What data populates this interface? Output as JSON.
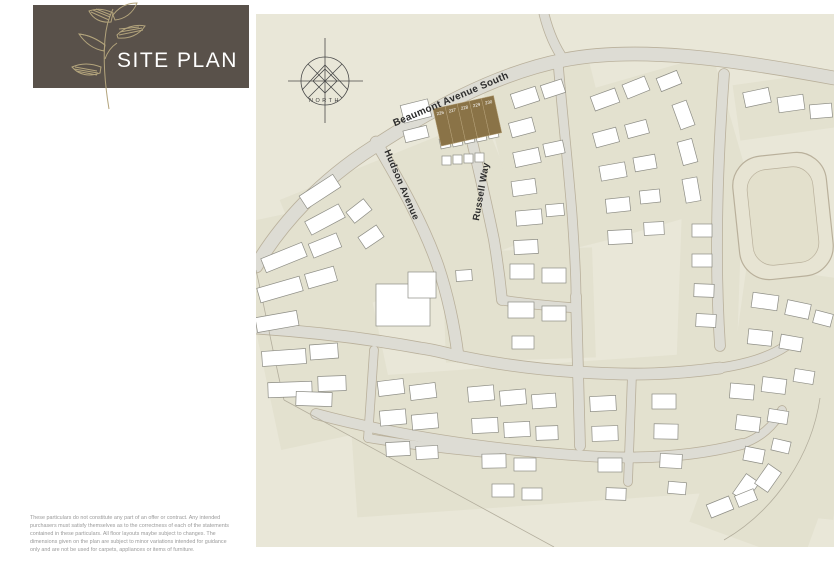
{
  "header": {
    "title": "SITE PLAN",
    "logo_bg": "#59514a",
    "logo_art_color": "#b3a47c",
    "title_color": "#ffffff"
  },
  "footer": {
    "lines": [
      "These particulars do not constitute any part of an offer or contract. Any intended",
      "purchasers must satisfy themselves as to the correctness of each of the statements",
      "contained in these particulars. All floor layouts maybe subject to changes. The",
      "dimensions given on the plan are subject to minor variations intended for guidance",
      "only and are not be used for carpets, appliances or items of furniture."
    ]
  },
  "map": {
    "background": "#e9e7d8",
    "patch_fill": "#e3e1cf",
    "road_fill": "#dddcd4",
    "road_edge": "#b9b09b",
    "building_fill": "#ffffff",
    "building_stroke": "#8d8d85",
    "boundary_stroke": "#b3ae9d",
    "label_color": "#2d2d2d",
    "plot_fill": "#8a7347",
    "plot_stroke": "#b7a37b",
    "plot_number_color": "#ffffff",
    "compass": {
      "label": "NORTH",
      "cx": 69,
      "cy": 67,
      "r": 24,
      "stroke": "#4a4a4a"
    },
    "streets": [
      {
        "id": "beaumont-avenue-south",
        "name": "Beaumont Avenue South",
        "x": 196,
        "y": 88,
        "rot": -23,
        "size": 10
      },
      {
        "id": "hudson-avenue",
        "name": "Hudson Avenue",
        "x": 143,
        "y": 172,
        "rot": 67,
        "size": 9.5
      },
      {
        "id": "russell-way",
        "name": "Russell Way",
        "x": 228,
        "y": 178,
        "rot": -80,
        "size": 9.5
      }
    ],
    "plots": {
      "x": 177,
      "y": 95,
      "rot": -12.5,
      "cell_w": 12.4,
      "cell_h": 38,
      "numbers": [
        "226",
        "227",
        "228",
        "229",
        "230"
      ]
    },
    "pond": {
      "x": 480,
      "y": 140,
      "w": 94,
      "h": 124,
      "rot": -6
    },
    "roads": [
      {
        "d": "M578,64 C470,44 380,32 308,46 C236,60 168,100 116,134 C66,166 26,208 0,252",
        "w": 13
      },
      {
        "d": "M308,46 C298,32 292,16 288,0",
        "w": 9
      },
      {
        "d": "M120,128 C146,172 168,212 182,252 C192,282 198,310 202,342",
        "w": 11
      },
      {
        "d": "M210,102 C220,144 230,186 238,226 C242,250 244,266 246,286",
        "w": 10
      },
      {
        "d": "M302,48 C306,96 312,150 316,200 C318,230 320,256 320,282",
        "w": 9
      },
      {
        "d": "M320,282 L324,432",
        "w": 10
      },
      {
        "d": "M468,60 C462,140 458,240 464,332",
        "w": 10
      },
      {
        "d": "M0,314 C60,318 120,326 164,334 C180,336 192,340 202,342",
        "w": 11
      },
      {
        "d": "M202,342 C250,352 290,356 322,358 C380,362 420,360 464,354",
        "w": 11
      },
      {
        "d": "M464,354 C490,350 512,344 530,332",
        "w": 9
      },
      {
        "d": "M246,286 C270,290 296,292 320,294",
        "w": 9
      },
      {
        "d": "M118,336 L112,424",
        "w": 8
      },
      {
        "d": "M376,360 L372,468",
        "w": 8
      },
      {
        "d": "M60,400 C150,424 240,436 330,442 C390,446 440,442 486,430",
        "w": 10
      },
      {
        "d": "M112,424 C160,432 200,436 240,440",
        "w": 8
      },
      {
        "d": "M486,430 C504,424 518,412 526,396",
        "w": 8
      }
    ],
    "patches": [
      [
        40,
        140,
        220,
        130,
        -22
      ],
      [
        246,
        56,
        110,
        180,
        -14
      ],
      [
        330,
        58,
        150,
        150,
        -16
      ],
      [
        480,
        64,
        100,
        56,
        -8
      ],
      [
        424,
        150,
        60,
        200,
        2
      ],
      [
        0,
        196,
        120,
        230,
        -12
      ],
      [
        96,
        350,
        390,
        140,
        -4
      ],
      [
        466,
        340,
        120,
        160,
        6
      ],
      [
        188,
        236,
        150,
        110,
        -2
      ],
      [
        484,
        258,
        100,
        90,
        8
      ],
      [
        440,
        470,
        120,
        60,
        20
      ]
    ],
    "boundaries": [
      "M28,386 L298,533",
      "M564,384 C556,440 520,496 468,526",
      "M0,256 C10,300 18,344 28,386"
    ],
    "buildings": [
      [
        44,
        170,
        40,
        15,
        -33
      ],
      [
        50,
        198,
        38,
        15,
        -28
      ],
      [
        6,
        236,
        44,
        15,
        -22
      ],
      [
        54,
        224,
        30,
        15,
        -22
      ],
      [
        2,
        268,
        44,
        15,
        -16
      ],
      [
        50,
        256,
        30,
        15,
        -16
      ],
      [
        0,
        300,
        42,
        15,
        -10
      ],
      [
        6,
        336,
        44,
        15,
        -4
      ],
      [
        54,
        330,
        28,
        15,
        -4
      ],
      [
        12,
        368,
        44,
        15,
        -2
      ],
      [
        62,
        362,
        28,
        15,
        -2
      ],
      [
        40,
        378,
        36,
        14,
        2
      ],
      [
        92,
        190,
        22,
        14,
        -38
      ],
      [
        104,
        216,
        22,
        14,
        -34
      ],
      [
        146,
        88,
        28,
        18,
        -14
      ],
      [
        148,
        114,
        24,
        12,
        -14
      ],
      [
        184,
        124,
        10,
        10,
        -12
      ],
      [
        196,
        122,
        10,
        10,
        -12
      ],
      [
        208,
        119,
        10,
        10,
        -12
      ],
      [
        220,
        117,
        10,
        10,
        -12
      ],
      [
        232,
        114,
        10,
        10,
        -12
      ],
      [
        186,
        142,
        9,
        9,
        0
      ],
      [
        197,
        141,
        9,
        9,
        0
      ],
      [
        208,
        140,
        9,
        9,
        0
      ],
      [
        219,
        139,
        9,
        9,
        0
      ],
      [
        256,
        76,
        26,
        15,
        -18
      ],
      [
        286,
        68,
        22,
        14,
        -18
      ],
      [
        254,
        106,
        24,
        15,
        -15
      ],
      [
        258,
        136,
        26,
        15,
        -12
      ],
      [
        288,
        128,
        20,
        13,
        -12
      ],
      [
        256,
        166,
        24,
        15,
        -8
      ],
      [
        260,
        196,
        26,
        15,
        -5
      ],
      [
        290,
        190,
        18,
        12,
        -5
      ],
      [
        258,
        226,
        24,
        14,
        -3
      ],
      [
        336,
        78,
        26,
        15,
        -20
      ],
      [
        368,
        66,
        24,
        15,
        -22
      ],
      [
        402,
        60,
        22,
        14,
        -22
      ],
      [
        338,
        116,
        24,
        15,
        -15
      ],
      [
        370,
        108,
        22,
        14,
        -15
      ],
      [
        344,
        150,
        26,
        15,
        -10
      ],
      [
        378,
        142,
        22,
        14,
        -10
      ],
      [
        350,
        184,
        24,
        14,
        -6
      ],
      [
        384,
        176,
        20,
        13,
        -6
      ],
      [
        420,
        88,
        15,
        26,
        -20
      ],
      [
        424,
        126,
        15,
        24,
        -15
      ],
      [
        428,
        164,
        15,
        24,
        -10
      ],
      [
        352,
        216,
        24,
        14,
        -3
      ],
      [
        388,
        208,
        20,
        13,
        -3
      ],
      [
        488,
        76,
        26,
        15,
        -12
      ],
      [
        522,
        82,
        26,
        15,
        -8
      ],
      [
        554,
        90,
        22,
        14,
        -5
      ],
      [
        436,
        210,
        20,
        13,
        0
      ],
      [
        436,
        240,
        20,
        13,
        0
      ],
      [
        438,
        270,
        20,
        13,
        2
      ],
      [
        440,
        300,
        20,
        13,
        3
      ],
      [
        496,
        280,
        26,
        15,
        8
      ],
      [
        530,
        288,
        24,
        15,
        12
      ],
      [
        558,
        298,
        18,
        13,
        15
      ],
      [
        492,
        316,
        24,
        15,
        6
      ],
      [
        524,
        322,
        22,
        14,
        10
      ],
      [
        254,
        250,
        24,
        15,
        0
      ],
      [
        286,
        254,
        24,
        15,
        0
      ],
      [
        252,
        288,
        26,
        16,
        0
      ],
      [
        286,
        292,
        24,
        15,
        0
      ],
      [
        256,
        322,
        22,
        13,
        0
      ],
      [
        120,
        270,
        54,
        42,
        0
      ],
      [
        152,
        258,
        28,
        26,
        0
      ],
      [
        200,
        256,
        16,
        11,
        -4
      ],
      [
        122,
        366,
        26,
        15,
        -7
      ],
      [
        154,
        370,
        26,
        15,
        -7
      ],
      [
        124,
        396,
        26,
        15,
        -5
      ],
      [
        156,
        400,
        26,
        15,
        -5
      ],
      [
        130,
        428,
        24,
        14,
        -3
      ],
      [
        160,
        432,
        22,
        13,
        -3
      ],
      [
        212,
        372,
        26,
        15,
        -5
      ],
      [
        244,
        376,
        26,
        15,
        -5
      ],
      [
        276,
        380,
        24,
        14,
        -4
      ],
      [
        216,
        404,
        26,
        15,
        -3
      ],
      [
        248,
        408,
        26,
        15,
        -3
      ],
      [
        280,
        412,
        22,
        14,
        -2
      ],
      [
        226,
        440,
        24,
        14,
        -1
      ],
      [
        258,
        444,
        22,
        13,
        0
      ],
      [
        236,
        470,
        22,
        13,
        0
      ],
      [
        266,
        474,
        20,
        12,
        0
      ],
      [
        334,
        382,
        26,
        15,
        -3
      ],
      [
        336,
        412,
        26,
        15,
        -2
      ],
      [
        342,
        444,
        24,
        14,
        0
      ],
      [
        350,
        474,
        20,
        12,
        2
      ],
      [
        396,
        380,
        24,
        15,
        0
      ],
      [
        398,
        410,
        24,
        15,
        1
      ],
      [
        404,
        440,
        22,
        14,
        3
      ],
      [
        412,
        468,
        18,
        12,
        5
      ],
      [
        474,
        370,
        24,
        15,
        5
      ],
      [
        506,
        364,
        24,
        15,
        7
      ],
      [
        538,
        356,
        20,
        13,
        9
      ],
      [
        480,
        402,
        24,
        15,
        7
      ],
      [
        512,
        396,
        20,
        13,
        9
      ],
      [
        488,
        434,
        20,
        14,
        11
      ],
      [
        516,
        426,
        18,
        12,
        13
      ],
      [
        482,
        462,
        16,
        24,
        35
      ],
      [
        504,
        452,
        16,
        24,
        35
      ],
      [
        452,
        486,
        24,
        14,
        -22
      ],
      [
        480,
        478,
        20,
        12,
        -22
      ]
    ]
  }
}
